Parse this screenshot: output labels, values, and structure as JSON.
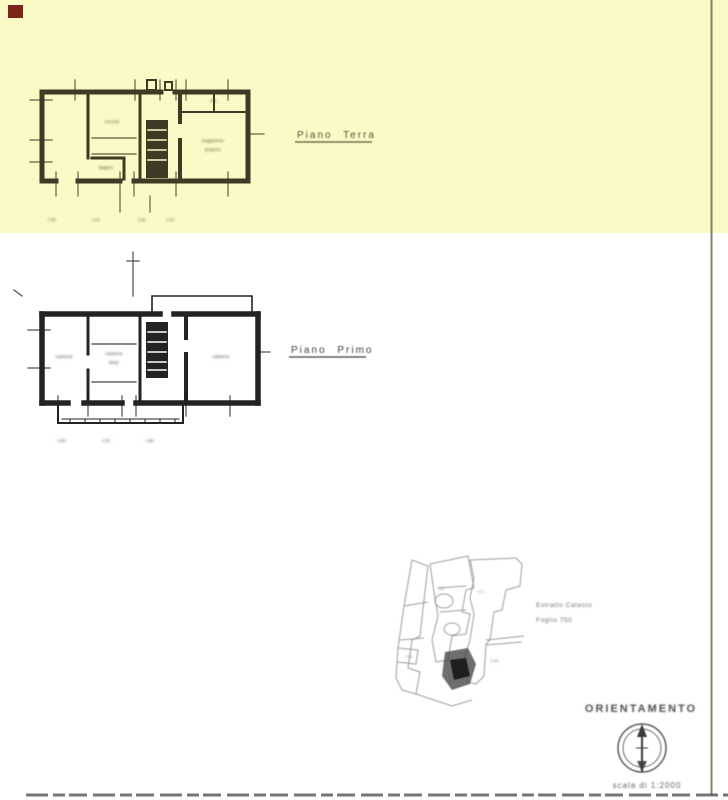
{
  "colors": {
    "yellow": "#fbf9c5",
    "paper": "#ffffff",
    "ground_ink": "#3e3b24",
    "first_ink": "#232323",
    "site_ink": "#9e9e9e",
    "frame": "#6e6a52",
    "marker": "#7a241b",
    "label_gray": "#4e4e4e"
  },
  "ground_floor": {
    "label": "Piano Terra",
    "rooms": {
      "storage": "rip.",
      "kitchen": "cucina",
      "bath": "bagno",
      "living1": "soggiorno",
      "living2": "pranzo"
    },
    "dims": [
      "3.50",
      "4.20",
      "2.80",
      "1.10"
    ]
  },
  "first_floor": {
    "label": "Piano Primo",
    "rooms": {
      "left": "camera",
      "mid1": "camera",
      "mid2": "letto",
      "right": "camera"
    },
    "dims": [
      "3.50",
      "4.20",
      "2.80"
    ]
  },
  "site_plan": {
    "note_line1": "Estratto Catasto",
    "note_line2": "Foglio 750",
    "parcels": [
      "971",
      "146",
      "258",
      "1038"
    ]
  },
  "orientation": {
    "title": "ORIENTAMENTO",
    "scale": "scala di 1:2000"
  }
}
